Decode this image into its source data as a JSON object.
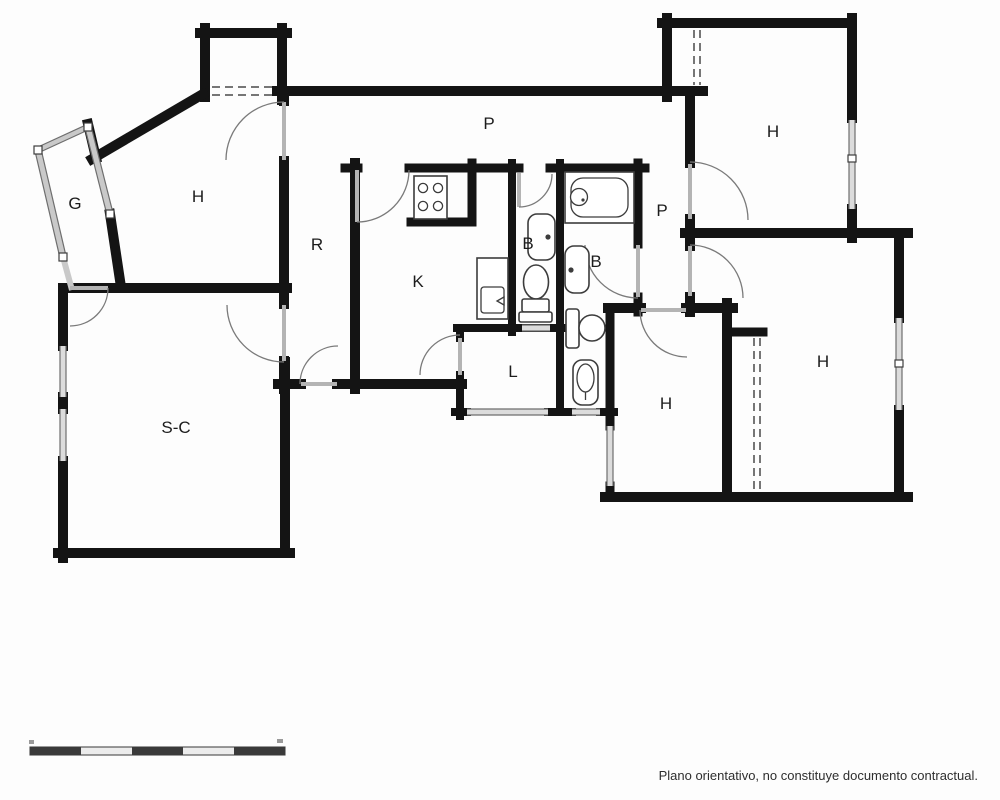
{
  "plan": {
    "rooms": [
      {
        "id": "galeria",
        "label": "G"
      },
      {
        "id": "habitacion-top-left",
        "label": "H"
      },
      {
        "id": "recibidor",
        "label": "R"
      },
      {
        "id": "cocina",
        "label": "K"
      },
      {
        "id": "bano-1",
        "label": "B"
      },
      {
        "id": "bano-2",
        "label": "B"
      },
      {
        "id": "pasillo-top",
        "label": "P"
      },
      {
        "id": "pasillo-right",
        "label": "P"
      },
      {
        "id": "habitacion-top-right",
        "label": "H"
      },
      {
        "id": "lavadero",
        "label": "L"
      },
      {
        "id": "salon-comedor",
        "label": "S-C"
      },
      {
        "id": "habitacion-bottom-middle",
        "label": "H"
      },
      {
        "id": "habitacion-bottom-right",
        "label": "H"
      }
    ],
    "fixtures": [
      "stove",
      "kitchen-sink",
      "bath1-sink",
      "bath1-toilet",
      "bath2-tub",
      "bath2-shower-head",
      "bath2-sink",
      "bath2-toilet",
      "bath2-bidet"
    ],
    "disclaimer": "Plano orientativo, no constituye documento contractual.",
    "colors": {
      "wall": "#141414",
      "glazing": "#c9c9c9",
      "door_arc": "#7a7a7a",
      "fixture_stroke": "#3c3c3c",
      "label": "#1c1c1c",
      "background": "#fdfdfd"
    },
    "scale_bar": {
      "segments": 5,
      "pattern": [
        "dark",
        "light",
        "dark",
        "light",
        "dark"
      ]
    }
  }
}
